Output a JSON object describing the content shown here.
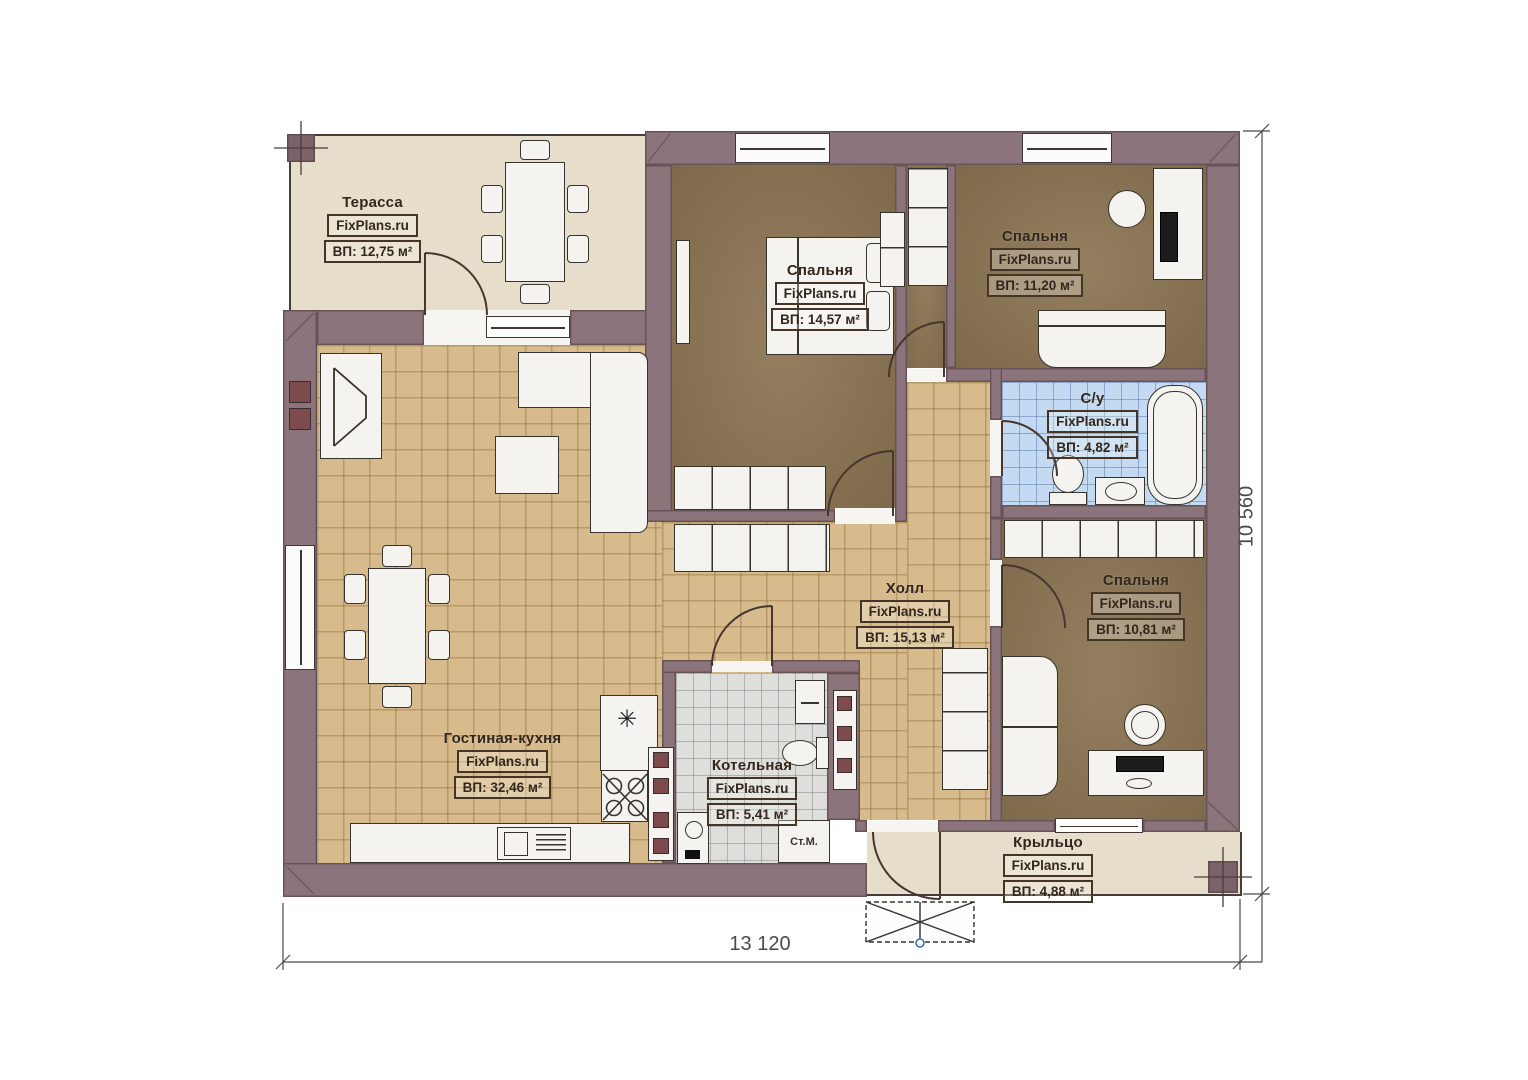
{
  "plan_title": "Одноэтажный дом — план этажа",
  "rooms": [
    {
      "id": "terrace",
      "name": "Терасса",
      "brand": "FixPlans.ru",
      "area": "ВП: 12,75 м²"
    },
    {
      "id": "bedroom1",
      "name": "Спальня",
      "brand": "FixPlans.ru",
      "area": "ВП: 14,57 м²"
    },
    {
      "id": "bedroom2",
      "name": "Спальня",
      "brand": "FixPlans.ru",
      "area": "ВП: 11,20 м²"
    },
    {
      "id": "bathroom",
      "name": "С/у",
      "brand": "FixPlans.ru",
      "area": "ВП: 4,82 м²"
    },
    {
      "id": "hall",
      "name": "Холл",
      "brand": "FixPlans.ru",
      "area": "ВП: 15,13 м²"
    },
    {
      "id": "bedroom3",
      "name": "Спальня",
      "brand": "FixPlans.ru",
      "area": "ВП: 10,81 м²"
    },
    {
      "id": "living_kitchen",
      "name": "Гостиная-кухня",
      "brand": "FixPlans.ru",
      "area": "ВП: 32,46 м²"
    },
    {
      "id": "boiler",
      "name": "Котельная",
      "brand": "FixPlans.ru",
      "area": "ВП: 5,41 м²"
    },
    {
      "id": "porch",
      "name": "Крыльцо",
      "brand": "FixPlans.ru",
      "area": "ВП: 4,88 м²"
    }
  ],
  "labels": {
    "washing_machine": "Ст.М.",
    "kitchen_symbol": "✳"
  },
  "dimensions": {
    "width": "13 120",
    "height": "10 560"
  },
  "colors": {
    "wall": "#8b747b",
    "bedroom_floor": "#8c7553",
    "tile_floor": "#d7bb8d",
    "bath_tile": "#c3daf2",
    "boiler_tile": "#dededb",
    "terrace_floor": "#e7ddcb",
    "cabinet_accent": "#7d4a4e",
    "steps_marker": "#3a6ea8"
  }
}
